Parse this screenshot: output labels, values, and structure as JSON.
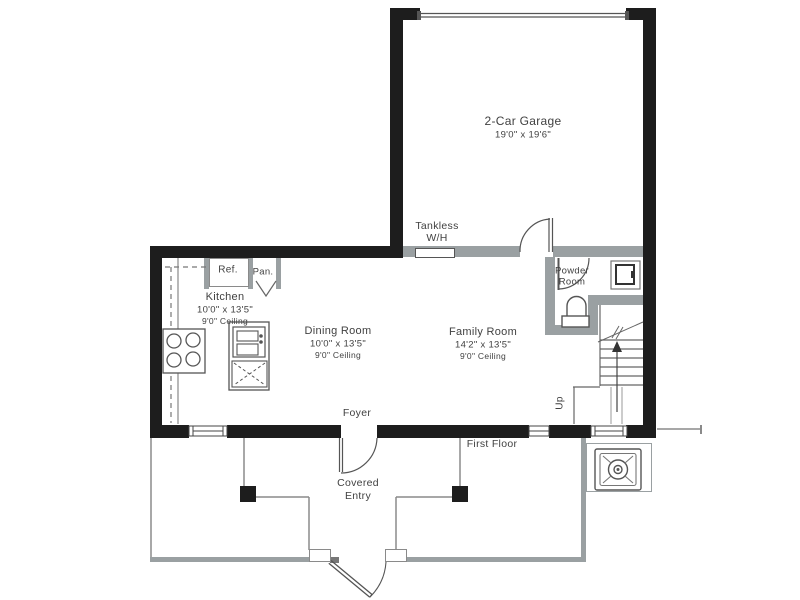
{
  "rooms": {
    "garage": {
      "label": "2-Car Garage",
      "dims": "19'0\" x 19'6\""
    },
    "kitchen": {
      "label": "Kitchen",
      "dims": "10'0\" x 13'5\"",
      "ceiling": "9'0\" Ceiling"
    },
    "dining_room": {
      "label": "Dining Room",
      "dims": "10'0\" x 13'5\"",
      "ceiling": "9'0\" Ceiling"
    },
    "family_room": {
      "label": "Family Room",
      "dims": "14'2\" x 13'5\"",
      "ceiling": "9'0\" Ceiling"
    },
    "powder_room": {
      "label_line1": "Powder",
      "label_line2": "Room"
    },
    "foyer": {
      "label": "Foyer"
    },
    "covered_entry": {
      "label_line1": "Covered",
      "label_line2": "Entry"
    }
  },
  "fixtures": {
    "tankless_line1": "Tankless",
    "tankless_line2": "W/H",
    "refrigerator": "Ref.",
    "pantry": "Pan."
  },
  "annotations": {
    "first_floor": "First Floor",
    "stairs_up": "Up"
  },
  "colors": {
    "exterior_wall": "#1d1d1d",
    "interior_wall": "#9aa0a2",
    "line": "#6e6e6e",
    "text": "#414141",
    "background": "#ffffff"
  }
}
